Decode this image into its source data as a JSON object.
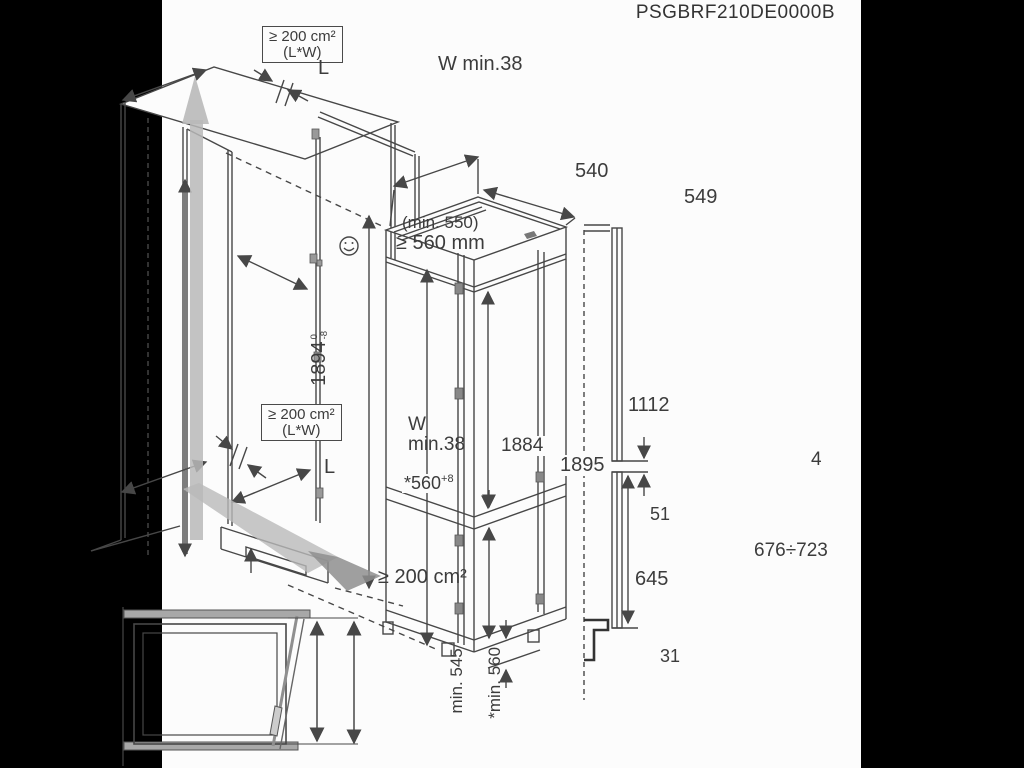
{
  "title": "PSGBRF210DE0000B",
  "colors": {
    "line": "#474747",
    "gray_fill": "#b9b9b9",
    "dark_gray_fill": "#8e8e8e",
    "background": "#fcfcfc",
    "letterbox": "#000000"
  },
  "niche": {
    "vent_area_top": {
      "line1": "≥ 200 cm²",
      "line2": "(L*W)"
    },
    "length_top": "L",
    "gap_top": "W min.38",
    "depth_note": "(min. 550)",
    "depth_min": "≥ 560 mm",
    "height_value": "1894",
    "height_tol_upper": "0",
    "height_tol_lower": "-8",
    "vent_area_mid": {
      "line1": "≥ 200 cm²",
      "line2": "(L*W)"
    },
    "gap_bottom_line1": "W",
    "gap_bottom_line2": "min.38",
    "length_bottom": "L",
    "niche_width_base": "*560",
    "niche_width_tol": "+8",
    "inner_height": "1884",
    "vent_bottom": "≥ 200 cm²"
  },
  "appliance": {
    "width": "540",
    "depth": "549",
    "height": "1895",
    "upper_door_height": "1112",
    "mid_gap": "51",
    "lower_door_height": "645",
    "bottom_clearance": "31"
  },
  "panel": {
    "gap": "4",
    "lower_panel_range": "676÷723"
  },
  "top_view": {
    "depth_min": "min. 545",
    "depth_with_door": "*min. 560"
  }
}
